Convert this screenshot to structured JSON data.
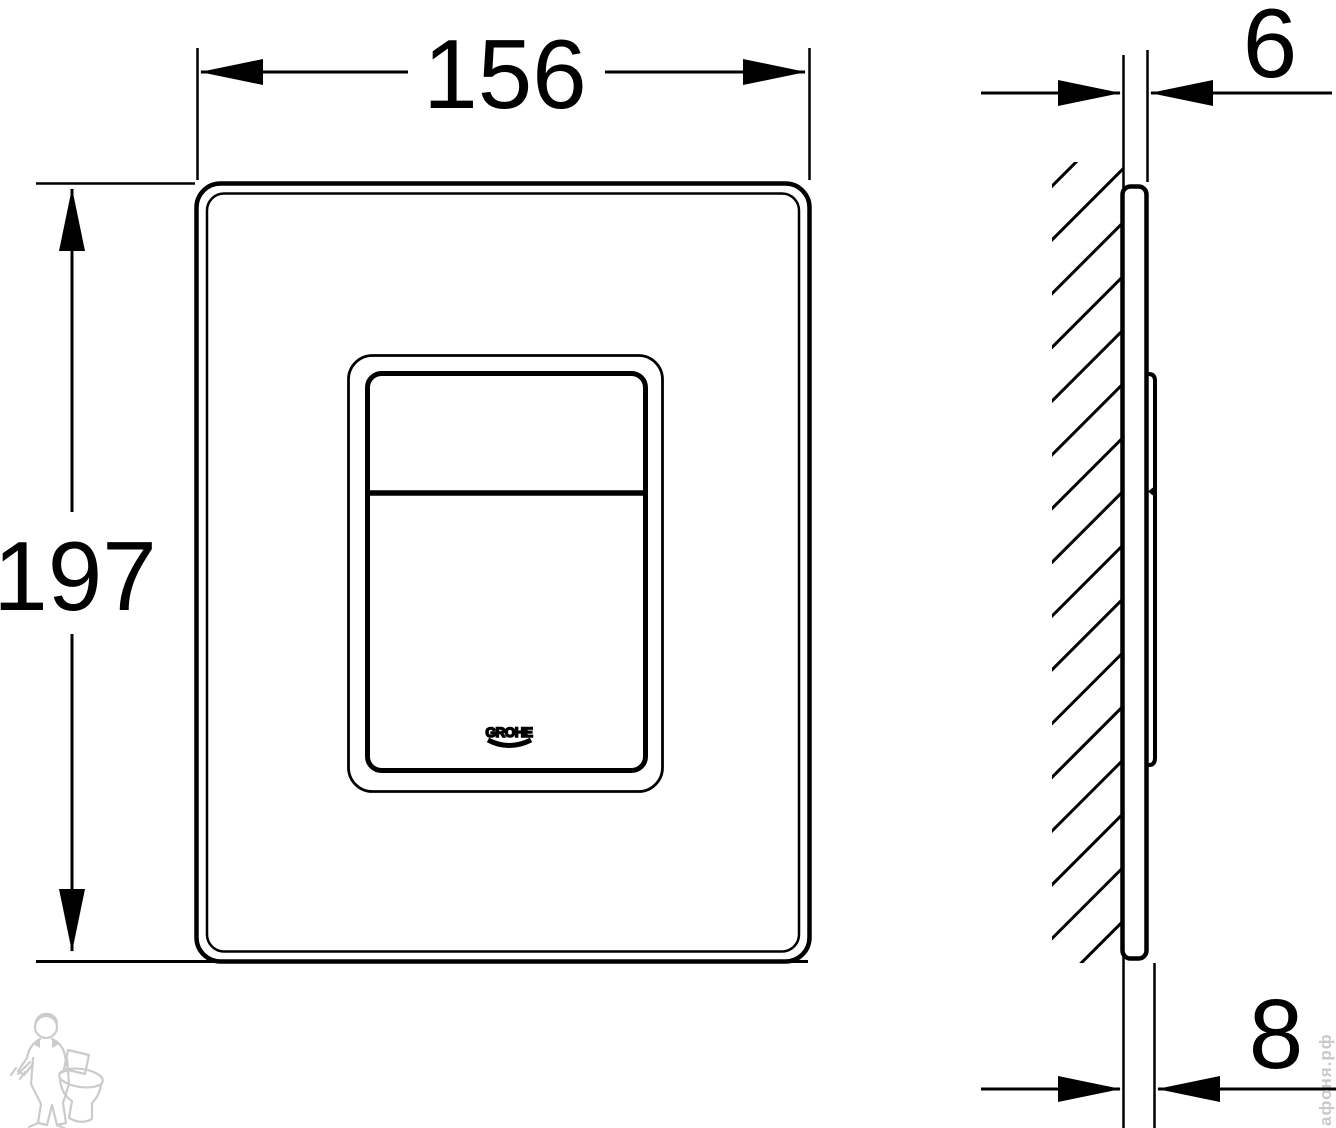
{
  "drawing": {
    "type": "technical-dimension-drawing",
    "subject": "wall-mounted flush actuation plate, front view and side section view",
    "front_view": {
      "width_label": "156",
      "height_label": "197",
      "logo_text": "GROHE"
    },
    "side_view": {
      "plate_thickness_label": "6",
      "total_depth_label": "8"
    },
    "watermark": {
      "site_text": "афоня.рф"
    },
    "colors": {
      "line": "#000000",
      "background": "#ffffff",
      "watermark": "#c9c9c9"
    }
  }
}
